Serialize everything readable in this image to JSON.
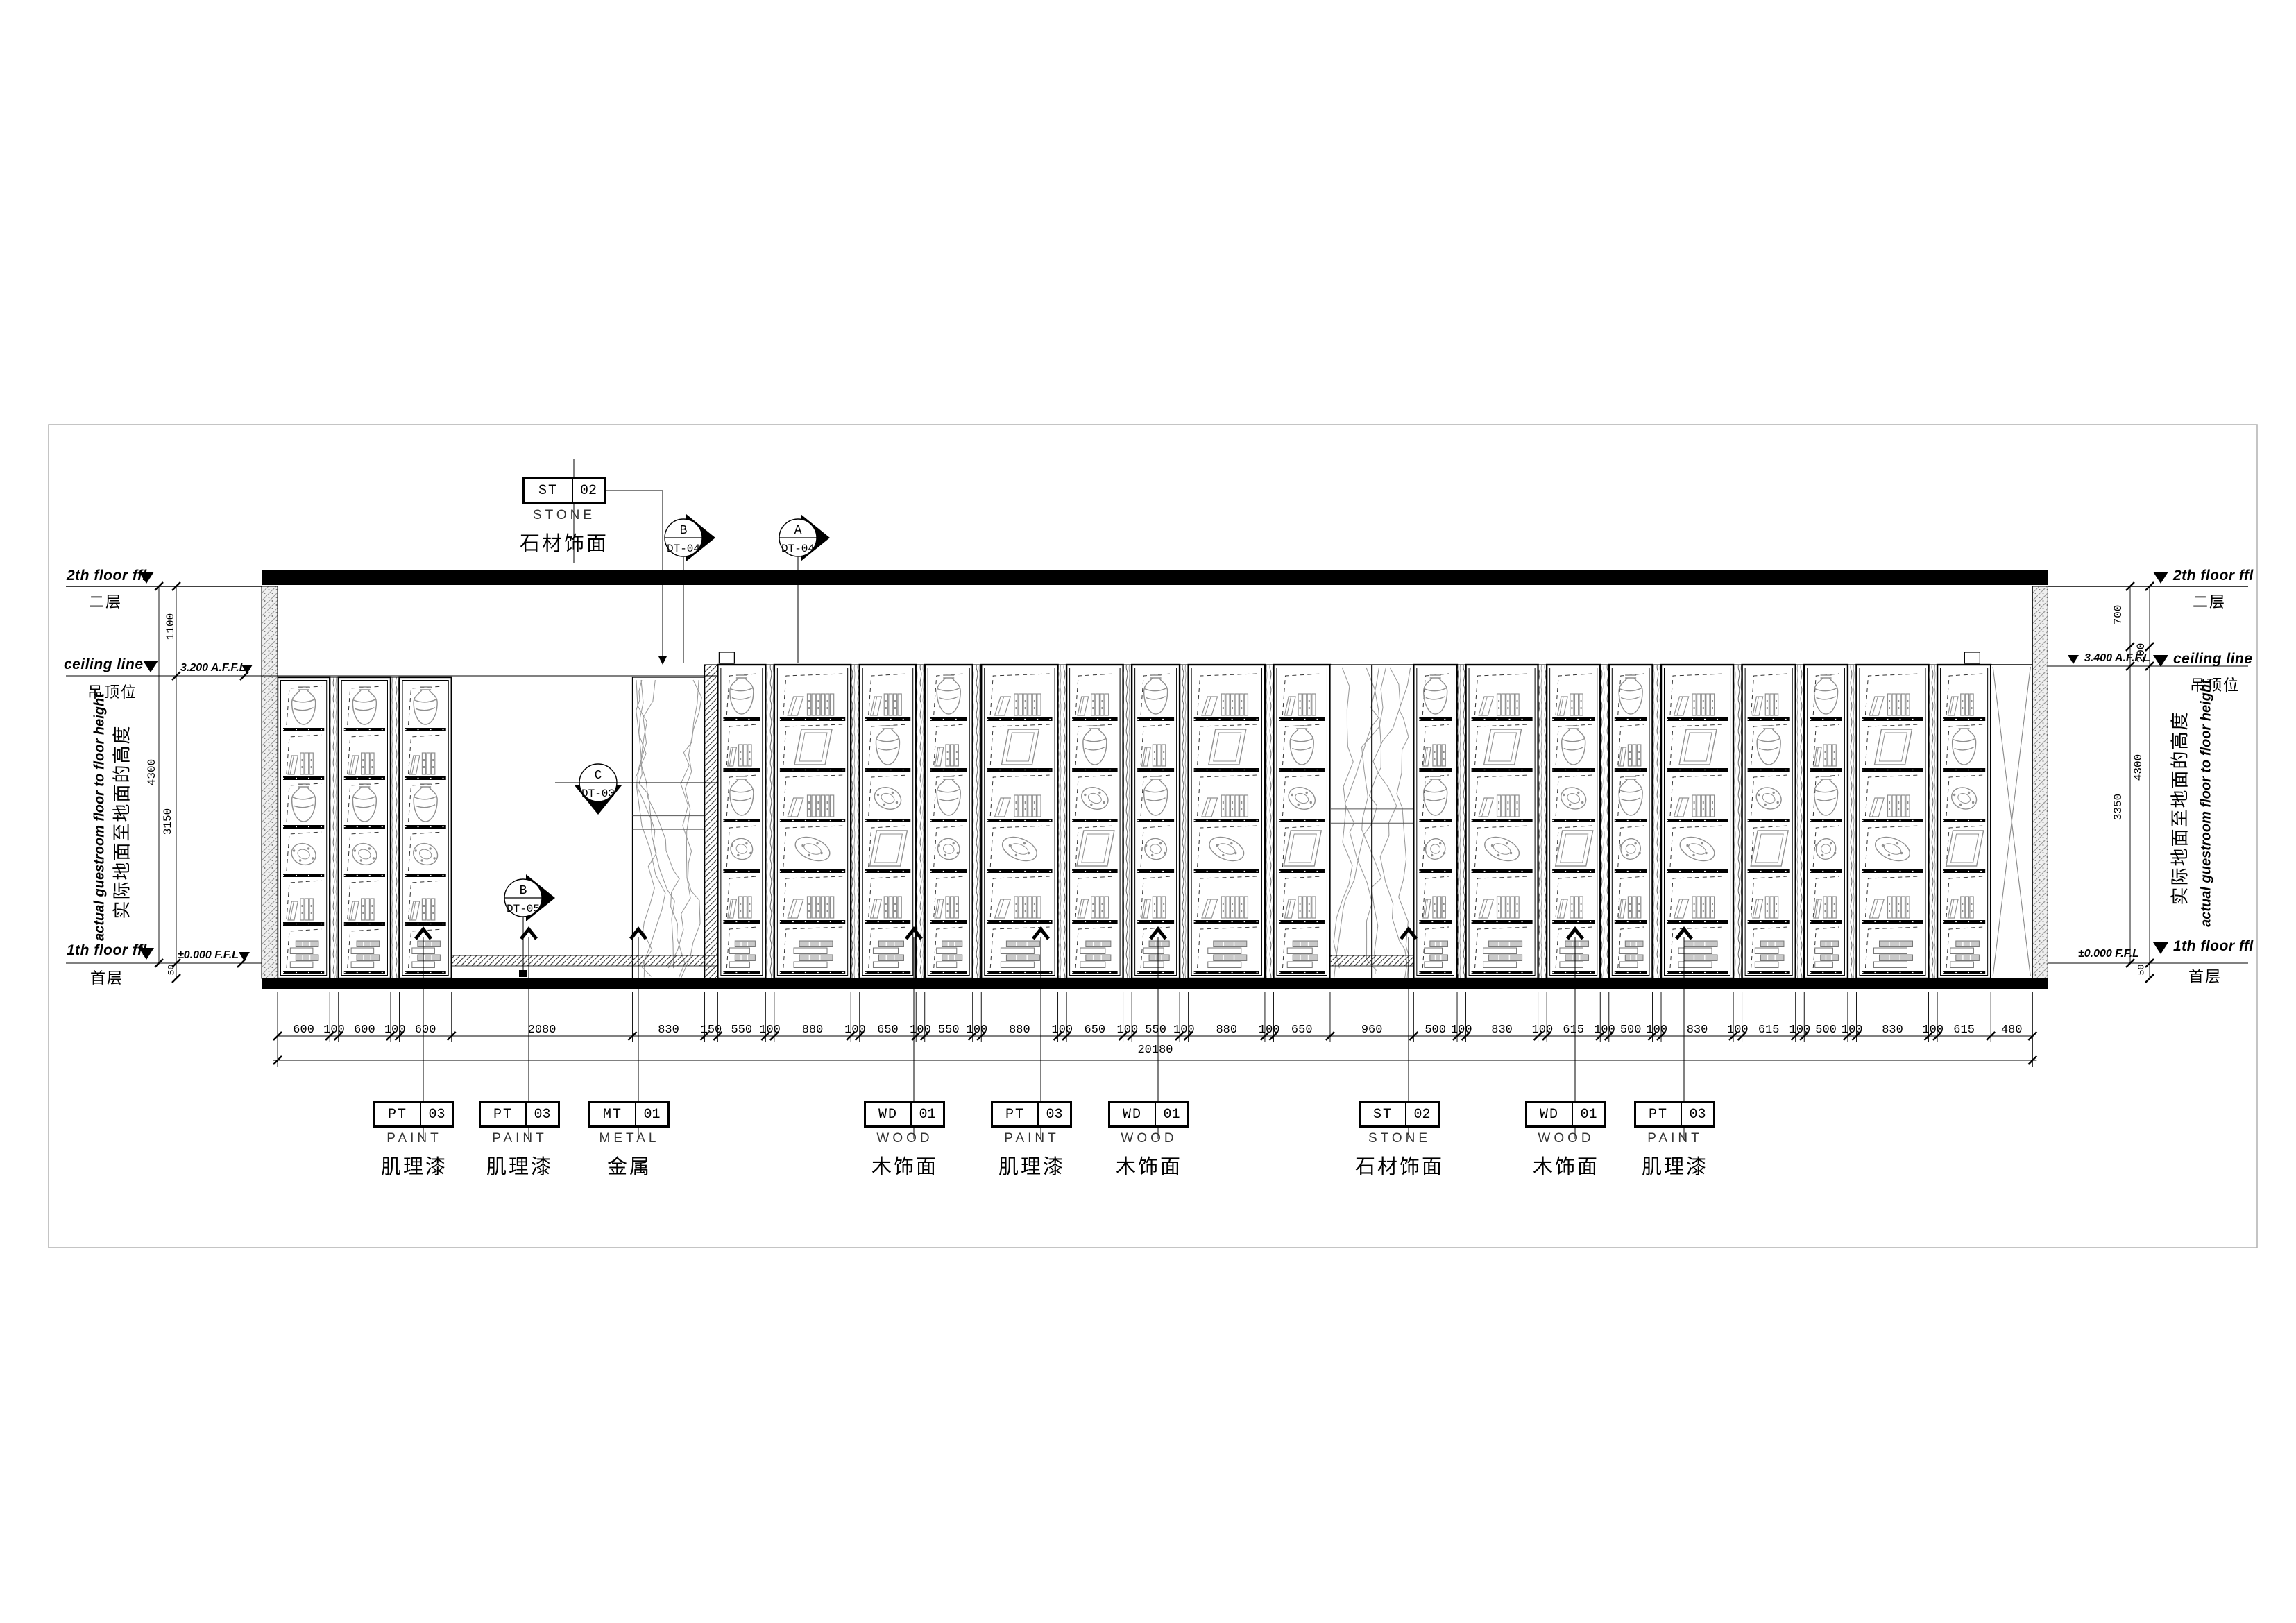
{
  "levels": {
    "left": {
      "floor2_en": "2th floor ffl",
      "floor2_cn": "二层",
      "ceiling_en": "ceiling line",
      "ceiling_cn": "吊顶位",
      "affl": "3.200 A.F.F.L",
      "floor1_en": "1th floor ffl",
      "floor1_cn": "首层",
      "ffl": "±0.000 F.F.L",
      "dim_upper": "1100",
      "dim_total": "4300",
      "dim_lower": "3150",
      "dim_floor": "50",
      "note_en": "actual guestroom floor to floor height",
      "note_cn": "实际地面至地面的高度"
    },
    "right": {
      "floor2_en": "2th floor ffl",
      "floor2_cn": "二层",
      "ceiling_en": "ceiling line",
      "ceiling_cn": "吊顶位",
      "affl": "3.400 A.F.F.L",
      "floor1_en": "1th floor ffl",
      "floor1_cn": "首层",
      "ffl": "±0.000 F.F.L",
      "dim_upper": "700",
      "dim_step": "200",
      "dim_total": "4300",
      "dim_lower": "3350",
      "dim_floor": "50",
      "note_en": "actual guestroom floor to floor height",
      "note_cn": "实际地面至地面的高度"
    }
  },
  "finish_tag_top": {
    "code": "ST",
    "num": "02",
    "en": "STONE",
    "cn": "石材饰面"
  },
  "section_markers": [
    {
      "letter": "B",
      "sheet": "DT-04"
    },
    {
      "letter": "A",
      "sheet": "DT-04"
    },
    {
      "letter": "C",
      "sheet": "DT-03"
    },
    {
      "letter": "B",
      "sheet": "DT-05"
    }
  ],
  "dimensions": {
    "chain": [
      600,
      100,
      600,
      100,
      600,
      2080,
      830,
      150,
      550,
      100,
      880,
      100,
      650,
      100,
      550,
      100,
      880,
      100,
      650,
      100,
      550,
      100,
      880,
      100,
      650,
      960,
      500,
      100,
      830,
      100,
      615,
      100,
      500,
      100,
      830,
      100,
      615,
      100,
      500,
      100,
      830,
      100,
      615,
      480
    ],
    "total": "20180"
  },
  "finish_tags_bottom": [
    {
      "code": "PT",
      "num": "03",
      "en": "PAINT",
      "cn": "肌理漆"
    },
    {
      "code": "PT",
      "num": "03",
      "en": "PAINT",
      "cn": "肌理漆"
    },
    {
      "code": "MT",
      "num": "01",
      "en": "METAL",
      "cn": "金属"
    },
    {
      "code": "WD",
      "num": "01",
      "en": "WOOD",
      "cn": "木饰面"
    },
    {
      "code": "PT",
      "num": "03",
      "en": "PAINT",
      "cn": "肌理漆"
    },
    {
      "code": "WD",
      "num": "01",
      "en": "WOOD",
      "cn": "木饰面"
    },
    {
      "code": "ST",
      "num": "02",
      "en": "STONE",
      "cn": "石材饰面"
    },
    {
      "code": "WD",
      "num": "01",
      "en": "WOOD",
      "cn": "木饰面"
    },
    {
      "code": "PT",
      "num": "03",
      "en": "PAINT",
      "cn": "肌理漆"
    }
  ],
  "colors": {
    "line": "#000000",
    "detail_gray": "#8f8f8f",
    "vein_gray": "#9a9a9a"
  }
}
